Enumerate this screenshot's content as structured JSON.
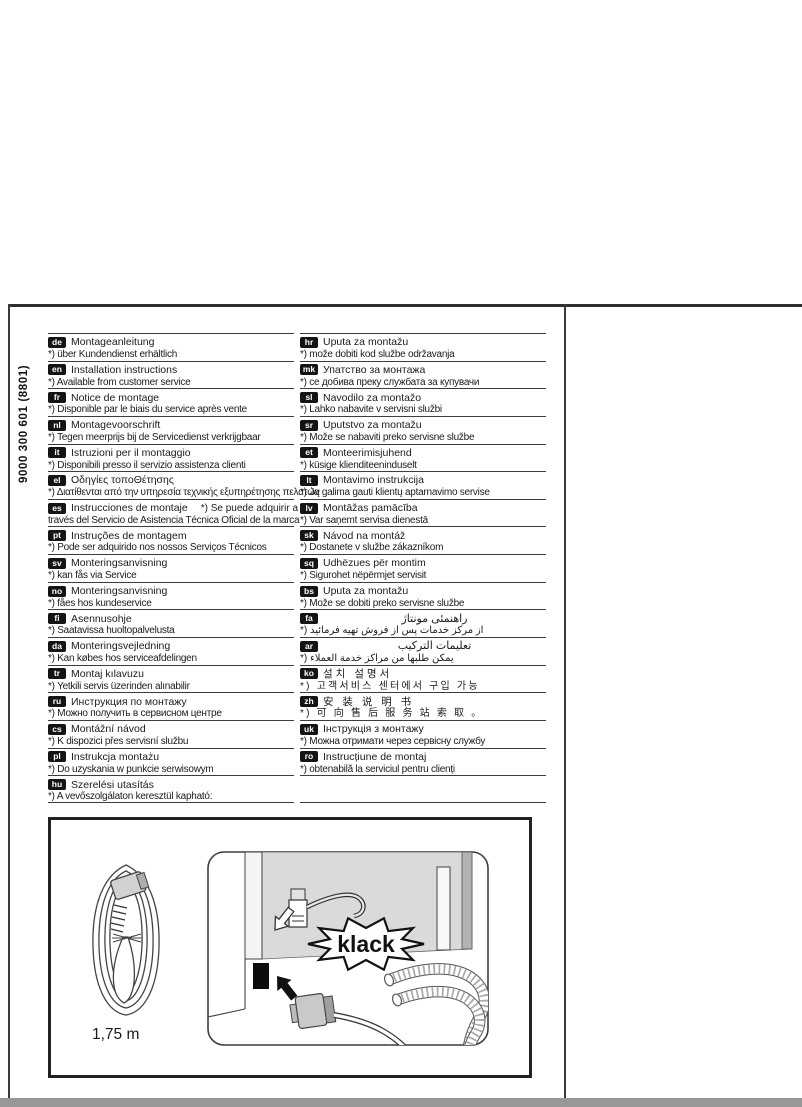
{
  "page": {
    "document_code_vertical": "9000 300 601  (8801)"
  },
  "colors": {
    "badge_bg": "#141414",
    "text": "#1b1b1b",
    "rule": "#3c3c3c",
    "panel_gray": "#dadada",
    "bottom_strip_gray": "#979797"
  },
  "table": {
    "left": [
      {
        "code": "de",
        "title": "Montageanleitung",
        "note": "*) über Kundendienst erhältlich"
      },
      {
        "code": "en",
        "title": "Installation instructions",
        "note": "*) Available from customer service"
      },
      {
        "code": "fr",
        "title": "Notice de montage",
        "note": "*) Disponible par le biais du service après vente"
      },
      {
        "code": "nl",
        "title": "Montagevoorschrift",
        "note": "*) Tegen meerprijs bij de Servicedienst verkrijgbaar"
      },
      {
        "code": "it",
        "title": "Istruzioni per il montaggio",
        "note": "*) Disponibili presso il servizio assistenza clienti"
      },
      {
        "code": "el",
        "title": "Οδηγίες τοποΘέτησης",
        "note": "*) Διατίθενται από την υπηρεσία τεχνικής εξυπηρέτησης πελατών"
      },
      {
        "code": "es",
        "title": "Instrucciones de montaje",
        "title_note": "*) Se puede adquirir a",
        "note": "través del Servicio de Asistencia Técnica Oficial de la marca"
      },
      {
        "code": "pt",
        "title": "Instruções de montagem",
        "note": "*) Pode ser adquirido nos nossos Serviços Técnicos"
      },
      {
        "code": "sv",
        "title": "Monteringsanvisning",
        "note": "*) kan fås via Service"
      },
      {
        "code": "no",
        "title": "Monteringsanvisning",
        "note": "*) fåes hos kundeservice"
      },
      {
        "code": "fi",
        "title": "Asennusohje",
        "note": "*) Saatavissa huoltopalvelusta"
      },
      {
        "code": "da",
        "title": "Monteringsvejledning",
        "note": "*) Kan købes hos serviceafdelingen"
      },
      {
        "code": "tr",
        "title": "Montaj kılavuzu",
        "note": "*) Yetkili servis üzerinden alınabilir"
      },
      {
        "code": "ru",
        "title": "Инструкция по монтажу",
        "note": "*) Можно получить в сервисном центре"
      },
      {
        "code": "cs",
        "title": "Montážní návod",
        "note": "*) K dispozici přes servisní službu"
      },
      {
        "code": "pl",
        "title": "Instrukcja montażu",
        "note": "*) Do uzyskania w punkcie serwisowym"
      },
      {
        "code": "hu",
        "title": "Szerelési utasítás",
        "note": "*) A vevőszolgálaton keresztül kapható:"
      }
    ],
    "right": [
      {
        "code": "hr",
        "title": "Uputa za montažu",
        "note": "*) može dobiti kod službe održavanja"
      },
      {
        "code": "mk",
        "title": "Упатство за монтажа",
        "note": "*) се добива преку службата за купувачи"
      },
      {
        "code": "sl",
        "title": "Navodilo za montažo",
        "note": "*) Lahko nabavite v servisni službi"
      },
      {
        "code": "sr",
        "title": "Uputstvo za montažu",
        "note": "*) Može se nabaviti preko servisne službe"
      },
      {
        "code": "et",
        "title": "Monteerimisjuhend",
        "note": "*) küsige klienditeeninduselt"
      },
      {
        "code": "lt",
        "title": "Montavimo instrukcija",
        "note": "*) Ją galima gauti klientų aptarnavimo servise"
      },
      {
        "code": "lv",
        "title": "Montāžas pamācība",
        "note": "*) Var saņemt servisa dienestā"
      },
      {
        "code": "sk",
        "title": "Návod na montáž",
        "note": "*) Dostanete v službe zákazníkom"
      },
      {
        "code": "sq",
        "title": "Udhëzues për montim",
        "note": "*) Sigurohet nëpërmjet servisit"
      },
      {
        "code": "bs",
        "title": "Uputa za montažu",
        "note": "*) Može se dobiti preko servisne službe"
      },
      {
        "code": "fa",
        "title": "راهنمئی مونتاژ",
        "note": "*) از مرکز خدمات پس از فروش تهیه فرمائید"
      },
      {
        "code": "ar",
        "title": "تعليمات التركيب",
        "note": "*) يمكن طلبها من مراكز خدمة العملاء"
      },
      {
        "code": "ko",
        "title": "설치 설명서",
        "note": "*) 고객서비스 센터에서 구입 가능"
      },
      {
        "code": "zh",
        "title": "安 装 说 明 书",
        "note": "*) 可 向 售 后 服 务 站 索 取 。"
      },
      {
        "code": "uk",
        "title": "Інструкція з монтажу",
        "note": "*) Можна отримати через сервісну службу"
      },
      {
        "code": "ro",
        "title": "Instrucțiune de montaj",
        "note": "*) obtenabilă la serviciul pentru clienți"
      },
      {
        "code": "",
        "title": "",
        "note": ""
      }
    ]
  },
  "figure": {
    "cord_length_label": "1,75 m",
    "klack_label": "klack"
  }
}
